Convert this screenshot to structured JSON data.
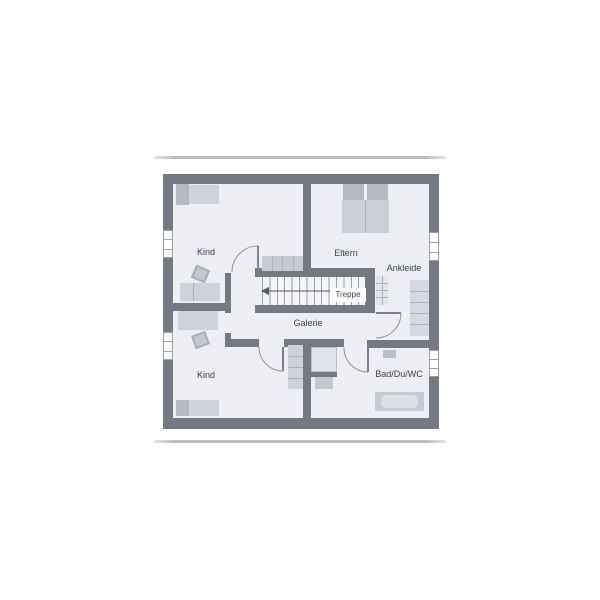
{
  "plan": {
    "type": "floor-plan",
    "rooms": [
      {
        "id": "kind-top",
        "label": "Kind"
      },
      {
        "id": "eltern",
        "label": "Eltern"
      },
      {
        "id": "ankleide",
        "label": "Ankleide"
      },
      {
        "id": "treppe",
        "label": "Treppe"
      },
      {
        "id": "galerie",
        "label": "Galerie"
      },
      {
        "id": "kind-bottom",
        "label": "Kind"
      },
      {
        "id": "bad",
        "label": "Bad/Du/WC"
      }
    ],
    "stairs": {
      "direction": "left"
    }
  },
  "theme": {
    "background": "#ffffff",
    "wall": "#747983",
    "floor": "#edeff4",
    "stair_bg": "#f3f5f8",
    "furniture": "#ced2da",
    "furniture_dark": "#b4b9c4",
    "line": "#9aa0a8",
    "text": "#3c414c",
    "separator": "#babcc0"
  }
}
